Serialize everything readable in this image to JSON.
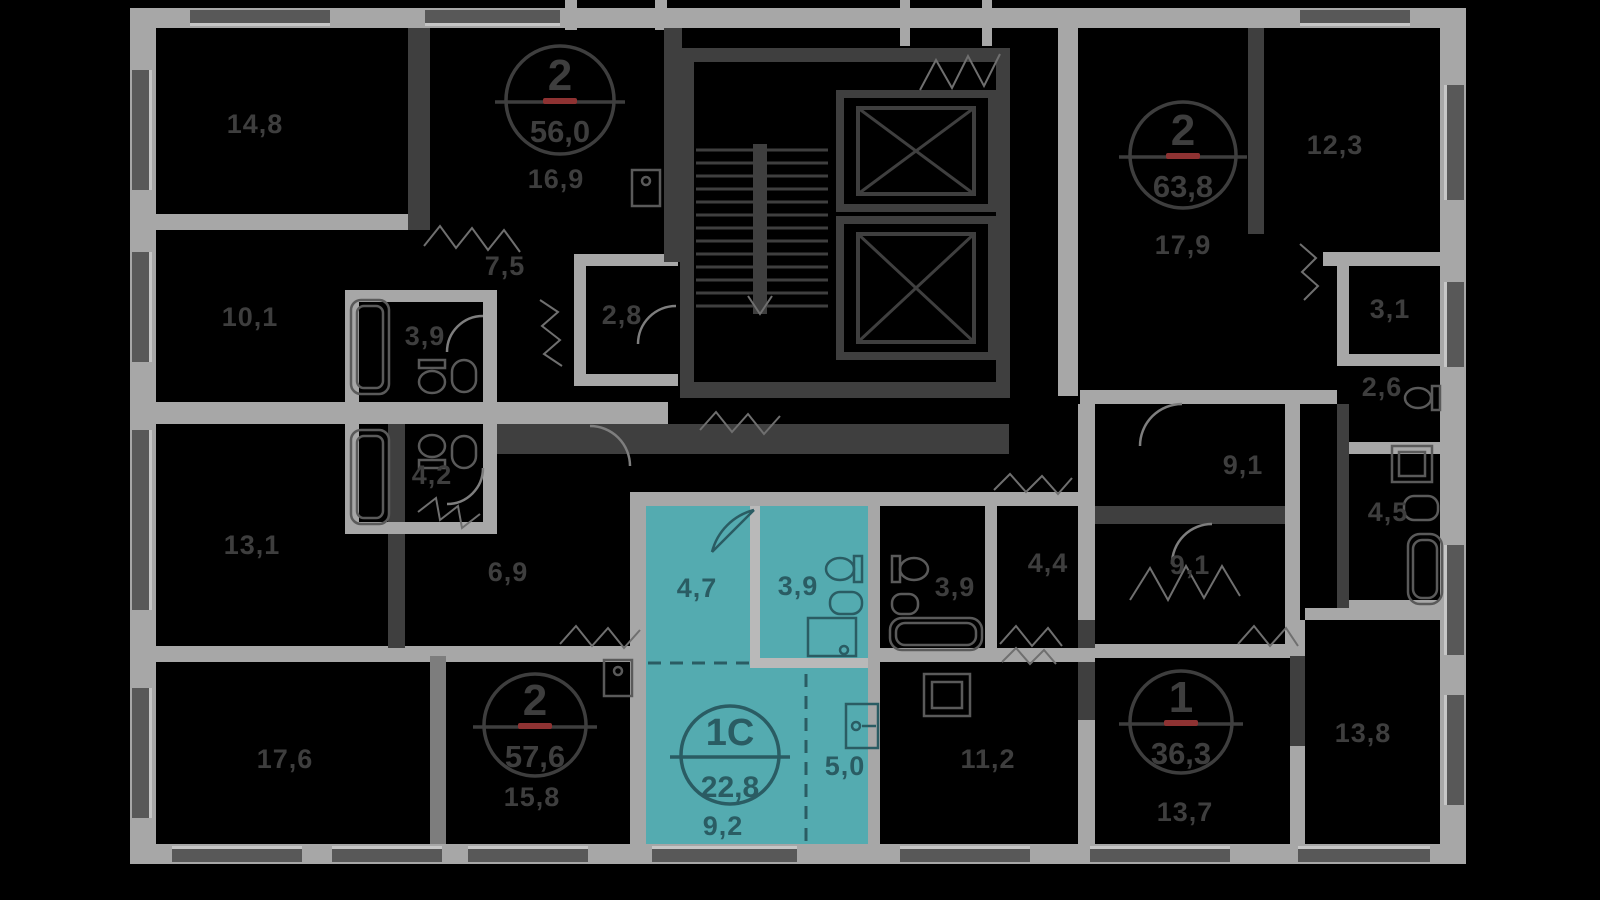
{
  "scene": {
    "width": 1600,
    "height": 900,
    "background": "#000000"
  },
  "palette": {
    "wall_light": "#a7a7a7",
    "wall_dark": "#3f3f3f",
    "label_text": "#3e3e3e",
    "highlight_fill": "#54abb0",
    "highlight_text": "#2a5c63",
    "red_accent": "#8e3232"
  },
  "selected_apartment": {
    "type_label": "1С",
    "total_area": "22,8",
    "badge": {
      "x": 730,
      "y": 755,
      "r": 49
    },
    "room_areas": [
      {
        "label": "4,7",
        "x": 697,
        "y": 597
      },
      {
        "label": "3,9",
        "x": 798,
        "y": 595
      },
      {
        "label": "5,0",
        "x": 845,
        "y": 775
      },
      {
        "label": "9,2",
        "x": 723,
        "y": 835
      }
    ]
  },
  "apartment_badges": [
    {
      "rooms": "2",
      "area": "56,0",
      "x": 560,
      "y": 100,
      "r": 54
    },
    {
      "rooms": "2",
      "area": "63,8",
      "x": 1183,
      "y": 155,
      "r": 53
    },
    {
      "rooms": "2",
      "area": "57,6",
      "x": 535,
      "y": 725,
      "r": 51
    },
    {
      "rooms": "1",
      "area": "36,3",
      "x": 1181,
      "y": 722,
      "r": 51
    }
  ],
  "room_labels": [
    {
      "label": "14,8",
      "x": 255,
      "y": 133
    },
    {
      "label": "16,9",
      "x": 556,
      "y": 188
    },
    {
      "label": "7,5",
      "x": 505,
      "y": 275
    },
    {
      "label": "10,1",
      "x": 250,
      "y": 326
    },
    {
      "label": "2,8",
      "x": 622,
      "y": 324
    },
    {
      "label": "3,9",
      "x": 425,
      "y": 345
    },
    {
      "label": "4,2",
      "x": 432,
      "y": 484
    },
    {
      "label": "13,1",
      "x": 252,
      "y": 554
    },
    {
      "label": "6,9",
      "x": 508,
      "y": 581
    },
    {
      "label": "17,6",
      "x": 285,
      "y": 768
    },
    {
      "label": "15,8",
      "x": 532,
      "y": 806
    },
    {
      "label": "17,9",
      "x": 1183,
      "y": 254
    },
    {
      "label": "12,3",
      "x": 1335,
      "y": 154
    },
    {
      "label": "3,1",
      "x": 1390,
      "y": 318
    },
    {
      "label": "2,6",
      "x": 1382,
      "y": 396
    },
    {
      "label": "4,5",
      "x": 1388,
      "y": 521
    },
    {
      "label": "9,1",
      "x": 1243,
      "y": 474
    },
    {
      "label": "9,1",
      "x": 1190,
      "y": 574
    },
    {
      "label": "4,4",
      "x": 1048,
      "y": 572
    },
    {
      "label": "3,9",
      "x": 955,
      "y": 596
    },
    {
      "label": "11,2",
      "x": 988,
      "y": 768
    },
    {
      "label": "13,7",
      "x": 1185,
      "y": 821
    },
    {
      "label": "13,8",
      "x": 1363,
      "y": 742
    }
  ]
}
